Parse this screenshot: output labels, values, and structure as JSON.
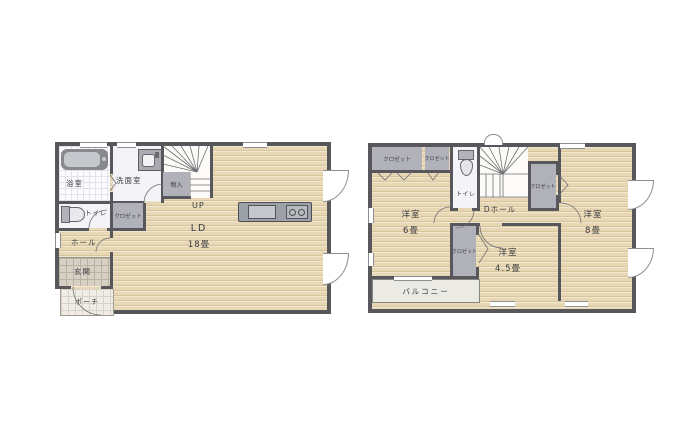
{
  "colors": {
    "wall": "#58585c",
    "wood_floor": "#e7d7b4",
    "closet_gray": "#b1b1b9",
    "label_text": "#3a3b40",
    "balcony_fill": "#eceae4"
  },
  "floor1": {
    "rooms": {
      "bath": {
        "label": "浴室"
      },
      "washroom": {
        "label": "洗面室"
      },
      "storage": {
        "label": "物入"
      },
      "stairs": {
        "label": "UP"
      },
      "toilet": {
        "label": "トイレ"
      },
      "closet": {
        "label": "クロゼット"
      },
      "hall": {
        "label": "ホール"
      },
      "entrance": {
        "label": "玄関"
      },
      "porch": {
        "label": "ポーチ"
      },
      "living": {
        "label": "LD",
        "size": "18畳"
      }
    }
  },
  "floor2": {
    "rooms": {
      "closet_a": {
        "label": "クロゼット"
      },
      "closet_b": {
        "label": "クロゼット"
      },
      "toilet": {
        "label": "トイレ"
      },
      "closet_c": {
        "label": "クロゼット"
      },
      "hall": {
        "label": "Dホール"
      },
      "room6": {
        "label": "洋室",
        "size": "6畳"
      },
      "room8": {
        "label": "洋室",
        "size": "8畳"
      },
      "room45": {
        "label": "洋室",
        "size": "4.5畳"
      },
      "closet_d": {
        "label": "クロゼット"
      },
      "balcony": {
        "label": "バルコニー"
      }
    }
  }
}
